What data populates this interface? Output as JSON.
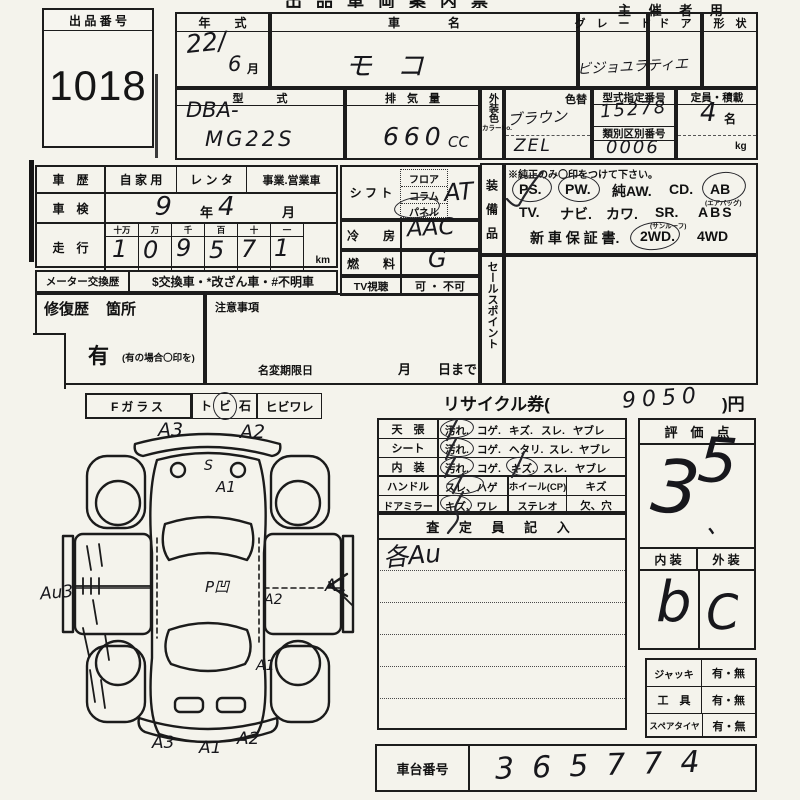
{
  "header": {
    "organizer": "主 催 者 用",
    "cropped_title": "出品車両案内票"
  },
  "auction": {
    "label": "出 品 番 号",
    "value": "1018"
  },
  "top": {
    "year_label": "年　　式",
    "year_value": "22/",
    "year_month_value": "6",
    "month_unit": "月",
    "name_label": "車　　　　名",
    "name_value": "モ コ",
    "grade_label": "グ　レ　ー　ド",
    "grade_value": "ビジョユラティエ",
    "door_label": "ド　ア",
    "shape_label": "形　状",
    "model_label": "型　　　式",
    "model_value1": "DBA-",
    "model_value2": "MG22S",
    "disp_label": "排　気　量",
    "disp_value": "660",
    "disp_unit": "CC",
    "color_label": "外装色",
    "color_no_label": "カラーNo.",
    "repaint_label": "色替",
    "color_value": "ブラウン",
    "color_no_value": "ZEL",
    "approval_label": "型式指定番号",
    "approval_value": "15278",
    "class_label": "類別区別番号",
    "class_value": "0006",
    "capacity_label": "定員・積載",
    "capacity_value": "4",
    "capacity_unit": "名",
    "capacity_kg": "kg"
  },
  "left": {
    "history_label": "車　歴",
    "history_opt1": "自 家 用",
    "history_opt2": "レ ン タ",
    "history_opt3": "事業.営業車",
    "inspection_label": "車　検",
    "inspection_year": "9",
    "inspection_year_unit": "年",
    "inspection_month": "4",
    "inspection_month_unit": "月",
    "mileage_label": "走　行",
    "mileage_cols": [
      "十万",
      "万",
      "千",
      "百",
      "十",
      "一"
    ],
    "mileage_digits": [
      "1",
      "0",
      "9",
      "5",
      "7",
      "1"
    ],
    "mileage_unit": "km",
    "meter_label": "メーター交換歴",
    "meter_opts": "$交換車・*改ざん車・#不明車",
    "repair_label": "修復歴",
    "repair_sub": "箇所",
    "repair_has": "有",
    "repair_note": "(有の場合〇印を)",
    "caution_label": "注意事項",
    "rename_label": "名変期限日",
    "rename_month": "月",
    "rename_day": "日まで"
  },
  "mid": {
    "shift_label": "シ フ ト",
    "shift_opts": [
      "フロア",
      "コラム",
      "パネル"
    ],
    "shift_value": "AT",
    "ac_label": "冷　　房",
    "ac_value": "AAC",
    "fuel_label": "燃　　料",
    "fuel_value": "G",
    "tv_label": "TV視聴",
    "tv_value": "可 ・ 不可"
  },
  "equip": {
    "label": "装　備　品",
    "note": "※純正のみ〇印をつけて下さい。",
    "ps": "PS.",
    "pw": "PW.",
    "aw": "純AW.",
    "cd": "CD.",
    "ab": "AB",
    "ab_sub": "(エアバッグ)",
    "tv": "TV.",
    "navi": "ナビ.",
    "kawa": "カワ.",
    "sr": "SR.",
    "abs": "ABS",
    "sr_sub": "(サンルーフ)",
    "warranty": "新 車 保 証 書.",
    "wd2": "2WD.",
    "wd4": "4WD"
  },
  "sales": {
    "label": "セールスポイント"
  },
  "glass": {
    "label": "Fガラス",
    "t": "ト",
    "bi": "ビ",
    "ishi": "石",
    "hibi": "ヒビワレ"
  },
  "recycle": {
    "pre": "リサイクル券(",
    "value": "9050",
    "post": ")円"
  },
  "condition": {
    "rows": [
      {
        "label": "天　張",
        "a": "汚れ.",
        "b": "コゲ.",
        "c": "キズ.",
        "d": "スレ.",
        "e": "ヤブレ"
      },
      {
        "label": "シート",
        "a": "汚れ.",
        "b": "コゲ.",
        "c": "ヘタリ.",
        "d": "スレ.",
        "e": "ヤブレ"
      },
      {
        "label": "内　装",
        "a": "汚れ.",
        "b": "コゲ.",
        "c": "キズ.",
        "d": "スレ.",
        "e": "ヤブレ"
      }
    ],
    "handle": {
      "label": "ハンドル",
      "opt": "スレ、ハゲ",
      "col2": "ホイール(CP)",
      "col3": "キズ"
    },
    "mirror": {
      "label": "ドアミラー",
      "opt": "キズ、ワレ",
      "col2": "ステレオ",
      "col3": "欠、穴"
    }
  },
  "assessor": {
    "label": "査 定 員 記 入",
    "entry": "各Au"
  },
  "score": {
    "label": "評　価　点",
    "d1": "3",
    "d2": "5",
    "dot": "、"
  },
  "grades": {
    "interior_label": "内 装",
    "exterior_label": "外 装",
    "interior_value": "b",
    "exterior_value": "C"
  },
  "tools": {
    "jack_label": "ジャッキ",
    "jack_value": "有・無",
    "tool_label": "工　具",
    "tool_value": "有・無",
    "spare_label": "スペアタイヤ",
    "spare_value": "有・無"
  },
  "chassis": {
    "label": "車台番号",
    "value": "365774"
  },
  "diagram": {
    "front_a3": "A3",
    "front_a2": "A2",
    "hood_s": "S",
    "hood_a1": "A1",
    "side_au3": "Au3",
    "center": "P凹",
    "right_a2": "A2",
    "right_a1": "A1",
    "rear_right_a1": "A1",
    "rear_a3": "A3",
    "rear_a1": "A1",
    "rear_a2": "A2"
  }
}
